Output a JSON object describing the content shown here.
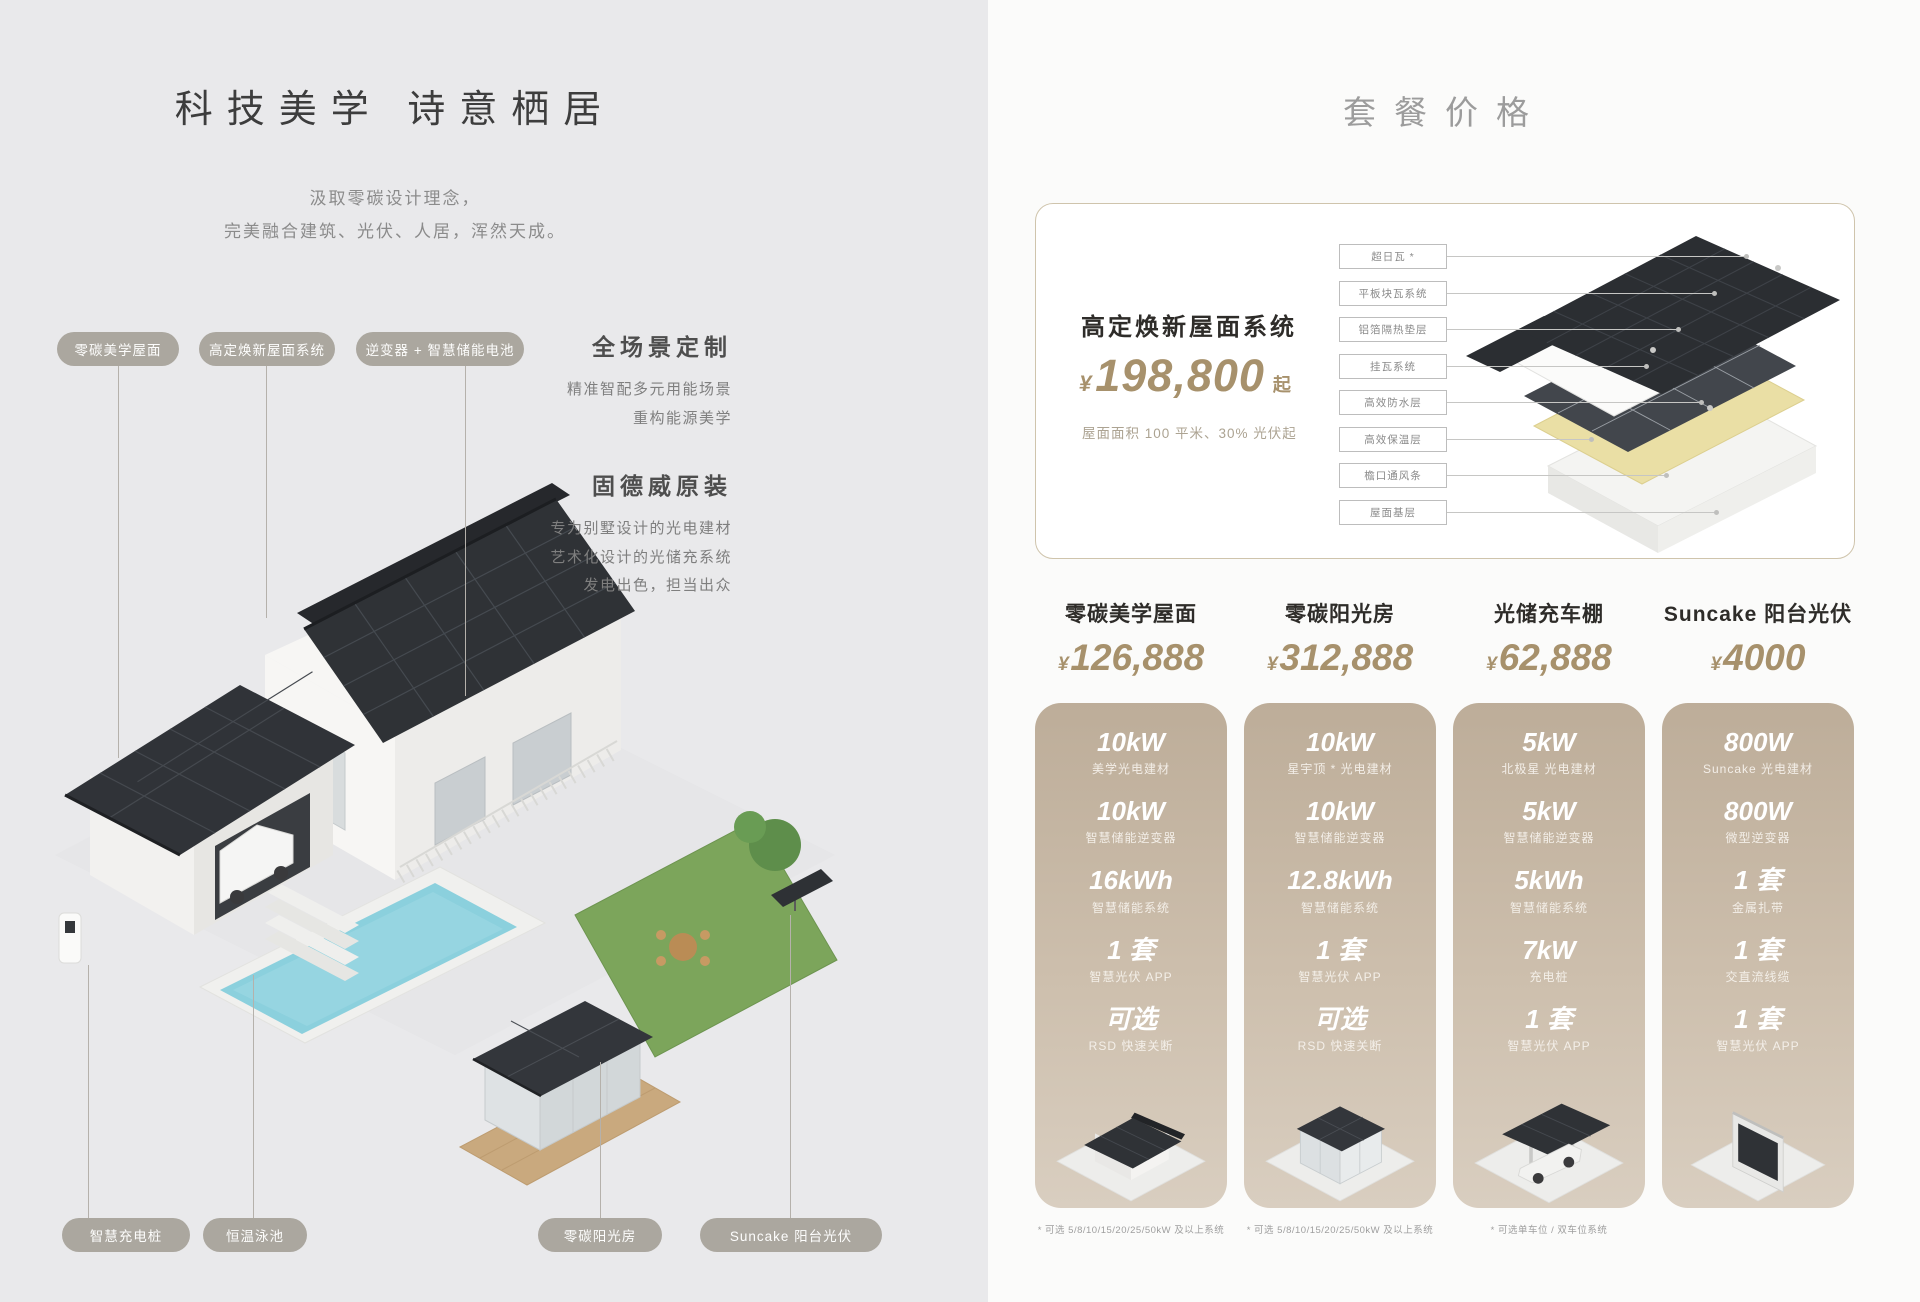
{
  "colors": {
    "left_background": "#E9E9EB",
    "right_background": "#FBFBFA",
    "pill": "#ABA79F",
    "price_gold": "#A7916C",
    "card_gradient_top": "#BDAD99",
    "card_gradient_bottom": "#D9CEC0",
    "roof_dark": "#2F3236"
  },
  "left": {
    "title": "科技美学 诗意栖居",
    "subtitle": [
      "汲取零碳设计理念，",
      "完美融合建筑、光伏、人居，浑然天成。"
    ],
    "top_labels": [
      "零碳美学屋面",
      "高定焕新屋面系统",
      "逆变器 + 智慧储能电池"
    ],
    "features": [
      {
        "heading": "全场景定制",
        "lines": [
          "精准智配多元用能场景",
          "重构能源美学"
        ]
      },
      {
        "heading": "固德威原装",
        "lines": [
          "专为别墅设计的光电建材",
          "艺术化设计的光储充系统",
          "发电出色，担当出众"
        ]
      }
    ],
    "bottom_labels": [
      "智慧充电桩",
      "恒温泳池",
      "零碳阳光房",
      "Suncake 阳台光伏"
    ]
  },
  "right": {
    "title": "套餐价格",
    "roof_system": {
      "name": "高定焕新屋面系统",
      "currency": "¥",
      "price": "198,800",
      "suffix": "起",
      "note": "屋面面积 100 平米、30% 光伏起",
      "layers": [
        "超日瓦 *",
        "平板块瓦系统",
        "铝箔隔热垫层",
        "挂瓦系统",
        "高效防水层",
        "高效保温层",
        "檐口通风条",
        "屋面基层"
      ]
    },
    "packages": [
      {
        "name": "零碳美学屋面",
        "currency": "¥",
        "price": "126,888",
        "specs": [
          {
            "value": "10kW",
            "label": "美学光电建材"
          },
          {
            "value": "10kW",
            "label": "智慧储能逆变器"
          },
          {
            "value": "16kWh",
            "label": "智慧储能系统"
          },
          {
            "value": "1 套",
            "label": "智慧光伏 APP"
          },
          {
            "value": "可选",
            "label": "RSD 快速关断"
          }
        ],
        "footnote": "* 可选 5/8/10/15/20/25/50kW 及以上系统"
      },
      {
        "name": "零碳阳光房",
        "currency": "¥",
        "price": "312,888",
        "specs": [
          {
            "value": "10kW",
            "label": "星宇顶 * 光电建材"
          },
          {
            "value": "10kW",
            "label": "智慧储能逆变器"
          },
          {
            "value": "12.8kWh",
            "label": "智慧储能系统"
          },
          {
            "value": "1 套",
            "label": "智慧光伏 APP"
          },
          {
            "value": "可选",
            "label": "RSD 快速关断"
          }
        ],
        "footnote": "* 可选 5/8/10/15/20/25/50kW 及以上系统"
      },
      {
        "name": "光储充车棚",
        "currency": "¥",
        "price": "62,888",
        "specs": [
          {
            "value": "5kW",
            "label": "北极星 光电建材"
          },
          {
            "value": "5kW",
            "label": "智慧储能逆变器"
          },
          {
            "value": "5kWh",
            "label": "智慧储能系统"
          },
          {
            "value": "7kW",
            "label": "充电桩"
          },
          {
            "value": "1 套",
            "label": "智慧光伏 APP"
          }
        ],
        "footnote": "* 可选单车位 / 双车位系统"
      },
      {
        "name": "Suncake 阳台光伏",
        "currency": "¥",
        "price": "4000",
        "specs": [
          {
            "value": "800W",
            "label": "Suncake 光电建材"
          },
          {
            "value": "800W",
            "label": "微型逆变器"
          },
          {
            "value": "1 套",
            "label": "金属扎带"
          },
          {
            "value": "1 套",
            "label": "交直流线缆"
          },
          {
            "value": "1 套",
            "label": "智慧光伏 APP"
          }
        ],
        "footnote": ""
      }
    ]
  }
}
